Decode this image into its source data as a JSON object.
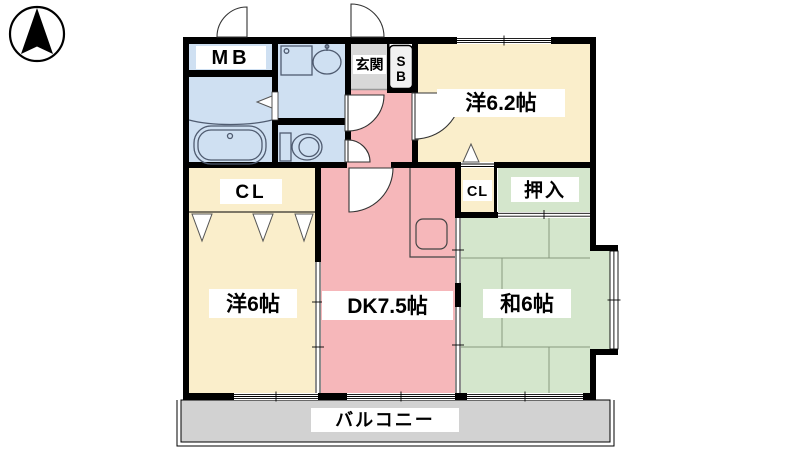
{
  "compass": {
    "name": "north-arrow"
  },
  "rooms": {
    "mb": {
      "label": "MB"
    },
    "genkan": {
      "label": "玄関"
    },
    "sb": {
      "label_top": "S",
      "label_bottom": "B"
    },
    "western_62": {
      "label": "洋6.2帖"
    },
    "cl_main": {
      "label": "CL"
    },
    "cl_small": {
      "label": "CL"
    },
    "oshiire": {
      "label": "押入"
    },
    "western_6": {
      "label": "洋6帖"
    },
    "dk": {
      "label": "DK7.5帖"
    },
    "washitsu": {
      "label": "和6帖"
    },
    "balcony": {
      "label": "バルコニー"
    }
  },
  "colors": {
    "wet_area": "#cfe0f2",
    "western_room": "#faeecb",
    "dk_pink": "#f6b7ba",
    "tatami_green": "#d4e6cc",
    "entrance_gray": "#d8d8d8",
    "balcony_gray": "#d2d2d2",
    "wall": "#000000"
  }
}
